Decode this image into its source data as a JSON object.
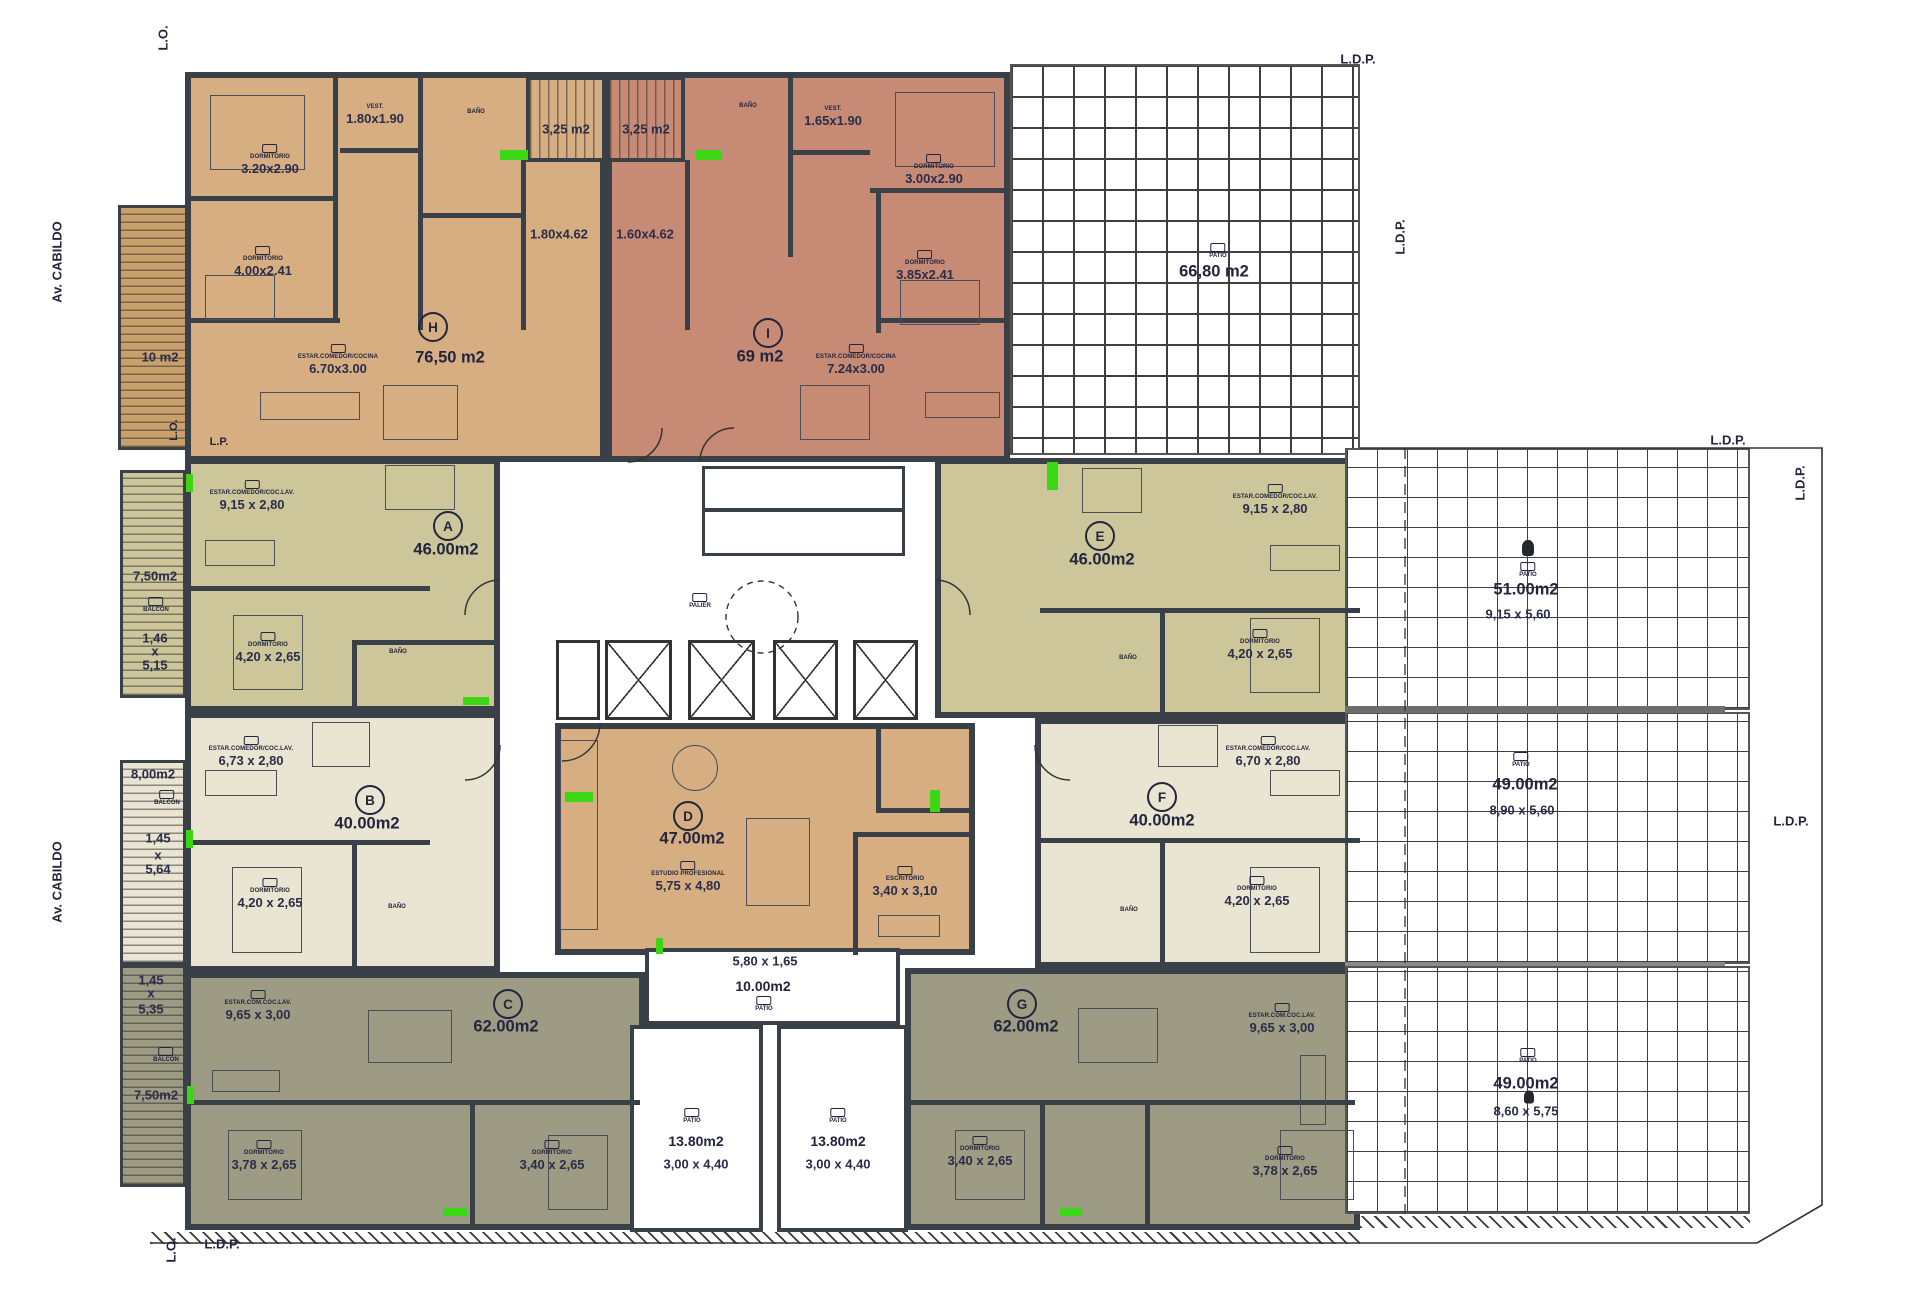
{
  "labels": {
    "street": "Av. CABILDO",
    "lo": "L.O.",
    "lp": "L.P.",
    "ldp": "L.D.P."
  },
  "core": {
    "palier": "PALIER"
  },
  "units": {
    "H": {
      "letter": "H",
      "area": "76,50 m2",
      "dorm1": {
        "name": "DORMITORIO",
        "dim": "3.20x2.90"
      },
      "vest": {
        "name": "VEST.",
        "dim": "1.80x1.90"
      },
      "dorm2": {
        "name": "DORMITORIO",
        "dim": "4.00x2.41"
      },
      "living": {
        "name": "ESTAR.COMEDOR/COCINA",
        "dim": "6.70x3.00"
      },
      "kitchen_dim": "1.80x4.62",
      "bath": "BAÑO"
    },
    "I": {
      "letter": "I",
      "area": "69 m2",
      "vest": {
        "name": "VEST.",
        "dim": "1.65x1.90"
      },
      "dorm1": {
        "name": "DORMITORIO",
        "dim": "3.00x2.90"
      },
      "dorm2": {
        "name": "DORMITORIO",
        "dim": "3.85x2.41"
      },
      "living": {
        "name": "ESTAR.COMEDOR/COCINA",
        "dim": "7.24x3.00"
      },
      "kitchen_dim": "1.60x4.62",
      "bath": "BAÑO"
    },
    "A": {
      "letter": "A",
      "area": "46.00m2",
      "living": {
        "name": "ESTAR.COMEDOR/COC.LAV.",
        "dim": "9,15 x 2,80"
      },
      "dorm": {
        "name": "DORMITORIO",
        "dim": "4,20 x 2,65"
      },
      "bath": "BAÑO"
    },
    "B": {
      "letter": "B",
      "area": "40.00m2",
      "living": {
        "name": "ESTAR.COMEDOR/COC.LAV.",
        "dim": "6,73 x 2,80"
      },
      "dorm": {
        "name": "DORMITORIO",
        "dim": "4,20 x 2,65"
      },
      "bath": "BAÑO"
    },
    "C": {
      "letter": "C",
      "area": "62.00m2",
      "living": {
        "name": "ESTAR.COM.COC.LAV.",
        "dim": "9,65 x 3,00"
      },
      "dorm1": {
        "name": "DORMITORIO",
        "dim": "3,78 x 2,65"
      },
      "dorm2": {
        "name": "DORMITORIO",
        "dim": "3,40 x 2,65"
      }
    },
    "D": {
      "letter": "D",
      "area": "47.00m2",
      "studio": {
        "name": "ESTUDIO PROFESIONAL",
        "dim": "5,75 x 4,80"
      },
      "office": {
        "name": "ESCRITORIO",
        "dim": "3,40 x 3,10"
      }
    },
    "E": {
      "letter": "E",
      "area": "46.00m2",
      "living": {
        "name": "ESTAR.COMEDOR/COC.LAV.",
        "dim": "9,15 x 2,80"
      },
      "dorm": {
        "name": "DORMITORIO",
        "dim": "4,20 x 2,65"
      },
      "bath": "BAÑO"
    },
    "F": {
      "letter": "F",
      "area": "40.00m2",
      "living": {
        "name": "ESTAR.COMEDOR/COC.LAV.",
        "dim": "6,70 x 2,80"
      },
      "dorm": {
        "name": "DORMITORIO",
        "dim": "4,20 x 2,65"
      },
      "bath": "BAÑO"
    },
    "G": {
      "letter": "G",
      "area": "62.00m2",
      "living": {
        "name": "ESTAR.COM.COC.LAV.",
        "dim": "9,65 x 3,00"
      },
      "dorm1": {
        "name": "DORMITORIO",
        "dim": "3,40 x 2,65"
      },
      "dorm2": {
        "name": "DORMITORIO",
        "dim": "3,78 x 2,65"
      }
    }
  },
  "outdoor": {
    "balcony_h": {
      "area": "10 m2"
    },
    "balcony_a": {
      "area": "7,50m2",
      "w": "1,46",
      "x": "x",
      "l": "5,15",
      "label": "BALCON"
    },
    "balcony_b": {
      "area": "8,00m2",
      "w": "1,45",
      "x": "x",
      "l": "5,64",
      "label": "BALCON"
    },
    "balcony_c": {
      "area": "7,50m2",
      "w": "1,45",
      "x": "x",
      "l": "5,35",
      "label": "BALCON"
    },
    "patio_top_left": {
      "area": "3,25 m2"
    },
    "patio_top_right": {
      "area": "3,25 m2"
    },
    "patio_ne": {
      "area": "66,80 m2",
      "label": "PATIO"
    },
    "patio_e1": {
      "area": "51.00m2",
      "dim": "9,15 x 5,60",
      "label": "PATIO"
    },
    "patio_e2": {
      "area": "49.00m2",
      "dim": "8,90 x 5,60",
      "label": "PATIO"
    },
    "patio_e3": {
      "area": "49.00m2",
      "dim": "8,60 x 5,75",
      "label": "PATIO"
    },
    "patio_c1": {
      "area": "10.00m2",
      "dim": "5,80 x 1,65",
      "label": "PATIO"
    },
    "patio_c2": {
      "area": "13.80m2",
      "dim": "3,00 x 4,40",
      "label": "PATIO"
    },
    "patio_c3": {
      "area": "13.80m2",
      "dim": "3,00 x 4,40",
      "label": "PATIO"
    }
  },
  "colors": {
    "tan": "#d6ae82",
    "salmon": "#c78b75",
    "olive": "#cdc69b",
    "cream": "#e9e5d2",
    "dark_olive": "#9d9b84",
    "wood": "#c9a06b",
    "accent_green": "#3bd715",
    "wall": "#3a4047",
    "text": "#2a2d4a"
  }
}
